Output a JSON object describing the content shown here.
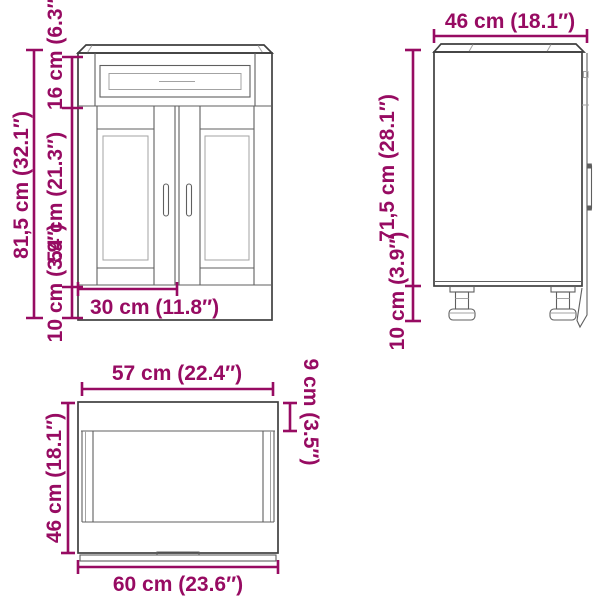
{
  "title": "Kitchen base cabinet dimension diagram",
  "colors": {
    "dimension": "#970b62",
    "outline": "#3f3f3f",
    "mid": "#5f5f5f",
    "detail": "#a3a3a3",
    "background": "#ffffff"
  },
  "front_view": {
    "total_height": "81,5 cm (32.1″)",
    "drawer_height": "16 cm (6.3″)",
    "door_height": "54 cm (21.3″)",
    "base_height": "10 cm (3.9″)",
    "door_width": "30 cm (11.8″)"
  },
  "side_view": {
    "depth": "46 cm (18.1″)",
    "body_height": "71,5 cm (28.1″)",
    "leg_height": "10 cm (3.9″)"
  },
  "top_view": {
    "inner_width": "57 cm (22.4″)",
    "back_panel_depth": "9 cm (3.5″)",
    "depth": "46 cm (18.1″)",
    "outer_width": "60 cm (23.6″)"
  }
}
